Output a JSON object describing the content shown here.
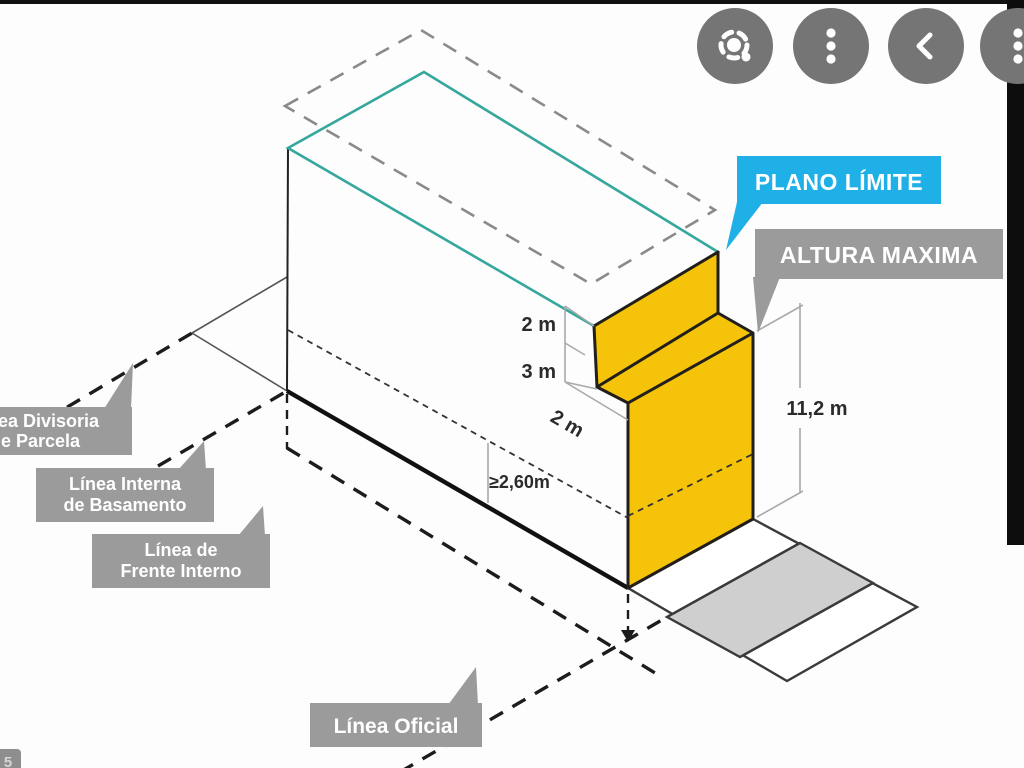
{
  "toolbar": {
    "lens_button": {
      "icon": "lens-icon"
    },
    "more_button": {
      "icon": "kebab-menu-icon"
    },
    "back_button": {
      "icon": "chevron-left-icon"
    },
    "edge_button": {
      "icon": "kebab-menu-icon"
    }
  },
  "diagram": {
    "callouts": {
      "plano_limite": {
        "label": "PLANO LÍMITE"
      },
      "altura_maxima": {
        "label": "ALTURA MAXIMA"
      },
      "linea_divisoria": {
        "line1": "Línea Divisoria",
        "line2": "de Parcela"
      },
      "linea_interna": {
        "line1": "Línea Interna",
        "line2": "de Basamento"
      },
      "linea_frente": {
        "line1": "Línea de",
        "line2": "Frente Interno"
      },
      "linea_oficial": {
        "label": "Línea Oficial"
      }
    },
    "dimensions": {
      "step_top": "2 m",
      "step_mid": "3 m",
      "step_run": "2 m",
      "clearance": "≥2,60m",
      "total_height": "11,2 m"
    },
    "colors": {
      "teal": "#35a79c",
      "yellow": "#f5c40a",
      "dark_outline": "#221f1a",
      "callout_gray": "#9b9b9b",
      "callout_blue": "#1fb0e8",
      "street_gray": "#cfcfcf",
      "dashed_gray": "#8a8a8a"
    }
  },
  "page_badge": "5"
}
